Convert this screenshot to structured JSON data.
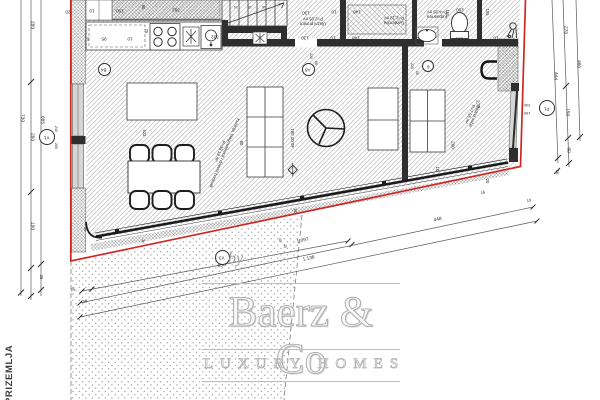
{
  "title": "PRIZEMLJA",
  "watermark": {
    "by": "by",
    "brand": "Baerz & Co",
    "tagline": "LUXURY HOMES"
  },
  "level_marker": "±0.00 381",
  "accent_red": "#cf2822",
  "rooms": [
    {
      "name": "Kuhinja, blagovaonica i dnevni boravak",
      "area": "P=38.19 m²",
      "x": 222,
      "y": 152,
      "r": 112,
      "s": 4.3,
      "w": 88
    },
    {
      "name": "Ulazni prostor",
      "area": "P=2.05 m²",
      "x": 313,
      "y": 21,
      "r": 180,
      "s": 4.3,
      "w": 0
    },
    {
      "name": "Garderoba",
      "area": "P=2.19 m²",
      "x": 394,
      "y": 20,
      "r": 180,
      "s": 4.3,
      "w": 0
    },
    {
      "name": "Kupaonica",
      "area": "P=4.05 m²",
      "x": 437,
      "y": 14,
      "r": 180,
      "s": 4.3,
      "w": 0
    },
    {
      "name": "Radna soba",
      "area": "P=7.55 m²",
      "x": 472,
      "y": 115,
      "r": 112,
      "s": 4.3,
      "w": 0
    }
  ],
  "circles": [
    {
      "t": "V1",
      "x": 47,
      "y": 137,
      "d": 16
    },
    {
      "t": "B4",
      "x": 104,
      "y": 69,
      "d": 13
    },
    {
      "t": "A8",
      "x": 308,
      "y": 69,
      "d": 13
    },
    {
      "t": "6",
      "x": 428,
      "y": 66,
      "d": 12
    },
    {
      "t": "V3",
      "x": 222,
      "y": 257,
      "d": 15
    },
    {
      "t": "P1",
      "x": 547,
      "y": 108,
      "d": 16
    }
  ],
  "dims": [
    {
      "t": "20",
      "x": 68,
      "y": 11,
      "r": 180,
      "s": 4.6
    },
    {
      "t": "10",
      "x": 92,
      "y": 10,
      "r": 180,
      "s": 4.6
    },
    {
      "t": "100",
      "x": 120,
      "y": 10,
      "r": 180,
      "s": 4.6
    },
    {
      "t": "392",
      "x": 176,
      "y": 9,
      "r": 180,
      "s": 4.6
    },
    {
      "t": "90",
      "x": 143,
      "y": 7,
      "r": 90,
      "s": 4.2
    },
    {
      "t": "75",
      "x": 146,
      "y": 31,
      "r": 90,
      "s": 4.2
    },
    {
      "t": "5",
      "x": 88,
      "y": 38,
      "r": 180,
      "s": 4.6
    },
    {
      "t": "95",
      "x": 104,
      "y": 38,
      "r": 180,
      "s": 4.6
    },
    {
      "t": "10",
      "x": 130,
      "y": 38,
      "r": 180,
      "s": 4.6
    },
    {
      "t": "332",
      "x": 215,
      "y": 36,
      "r": 180,
      "s": 4.6
    },
    {
      "t": "14",
      "x": 236,
      "y": 6,
      "r": 180,
      "s": 3.6
    },
    {
      "t": "15",
      "x": 250,
      "y": 6,
      "r": 180,
      "s": 3.6
    },
    {
      "t": "16",
      "x": 264,
      "y": 6,
      "r": 180,
      "s": 3.6
    },
    {
      "t": "130",
      "x": 306,
      "y": 12,
      "r": 180,
      "s": 4.6
    },
    {
      "t": "10",
      "x": 334,
      "y": 11,
      "r": 180,
      "s": 4.6
    },
    {
      "t": "148",
      "x": 357,
      "y": 11,
      "r": 180,
      "s": 4.6
    },
    {
      "t": "130",
      "x": 305,
      "y": 37,
      "r": 180,
      "s": 4.6
    },
    {
      "t": "10",
      "x": 333,
      "y": 37,
      "r": 180,
      "s": 4.6
    },
    {
      "t": "148",
      "x": 356,
      "y": 37,
      "r": 180,
      "s": 4.6
    },
    {
      "t": "220",
      "x": 310,
      "y": 56,
      "r": 90,
      "s": 3.5
    },
    {
      "t": "06",
      "x": 315,
      "y": 63,
      "r": 90,
      "s": 3.5
    },
    {
      "t": "155",
      "x": 447,
      "y": 13,
      "r": 90,
      "s": 4.2
    },
    {
      "t": "260",
      "x": 460,
      "y": 9,
      "r": 180,
      "s": 4.6
    },
    {
      "t": "260",
      "x": 459,
      "y": 38,
      "r": 180,
      "s": 4.6
    },
    {
      "t": "10",
      "x": 417,
      "y": 38,
      "r": 180,
      "s": 4.6
    },
    {
      "t": "10",
      "x": 496,
      "y": 37,
      "r": 180,
      "s": 4.6
    },
    {
      "t": "155",
      "x": 487,
      "y": 12,
      "r": 90,
      "s": 4.2
    },
    {
      "t": "220",
      "x": 411,
      "y": 66,
      "r": 90,
      "s": 3.5
    },
    {
      "t": "06",
      "x": 416,
      "y": 73,
      "r": 90,
      "s": 3.5
    },
    {
      "t": "273",
      "x": 477,
      "y": 104,
      "r": 90,
      "s": 4.6
    },
    {
      "t": "260",
      "x": 452,
      "y": 145,
      "r": 90,
      "s": 4.6
    },
    {
      "t": "10",
      "x": 437,
      "y": 169,
      "r": 90,
      "s": 4.2
    },
    {
      "t": "20",
      "x": 487,
      "y": 181,
      "r": 90,
      "s": 4.2
    },
    {
      "t": "240",
      "x": 527,
      "y": 105,
      "r": 180,
      "s": 4
    },
    {
      "t": "150",
      "x": 527,
      "y": 113,
      "r": 180,
      "s": 4
    },
    {
      "t": "522",
      "x": 144,
      "y": 133,
      "r": 90,
      "s": 4.2
    },
    {
      "t": "80",
      "x": 241,
      "y": 143,
      "r": 90,
      "s": 4.2
    },
    {
      "t": "50",
      "x": 295,
      "y": 211,
      "r": 90,
      "s": 4.2
    },
    {
      "t": "30",
      "x": 142,
      "y": 241,
      "r": 102,
      "s": 3.8
    },
    {
      "t": "30",
      "x": 84,
      "y": 229,
      "r": 90,
      "s": 3.8
    },
    {
      "t": "40",
      "x": 279,
      "y": 240,
      "r": 90,
      "s": 3.5
    },
    {
      "t": "25",
      "x": 284,
      "y": 246,
      "r": 90,
      "s": 3.5
    },
    {
      "t": "240",
      "x": 55,
      "y": 129,
      "r": 90,
      "s": 3.8
    },
    {
      "t": "260",
      "x": 55,
      "y": 146,
      "r": 90,
      "s": 3.8
    },
    {
      "t": "280",
      "x": 31,
      "y": 25,
      "r": 90,
      "s": 4.8
    },
    {
      "t": "260",
      "x": 31,
      "y": 137,
      "r": 90,
      "s": 4.8
    },
    {
      "t": "190",
      "x": 31,
      "y": 226,
      "r": 90,
      "s": 4.8
    },
    {
      "t": "730",
      "x": 21,
      "y": 118,
      "r": 90,
      "s": 4.8
    },
    {
      "t": "685",
      "x": 41,
      "y": 120,
      "r": 90,
      "s": 4.8
    },
    {
      "t": "25",
      "x": 41,
      "y": 277,
      "r": 90,
      "s": 4.2
    },
    {
      "t": "270",
      "x": 564,
      "y": 30,
      "r": 93,
      "s": 4.8
    },
    {
      "t": "150",
      "x": 566,
      "y": 112,
      "r": 93,
      "s": 4.8
    },
    {
      "t": "60",
      "x": 567,
      "y": 150,
      "r": 93,
      "s": 4.8
    },
    {
      "t": "480",
      "x": 577,
      "y": 64,
      "r": 93,
      "s": 4.8
    },
    {
      "t": "444",
      "x": 554,
      "y": 76,
      "r": 93,
      "s": 4.8
    },
    {
      "t": "16",
      "x": 557,
      "y": 172,
      "r": 93,
      "s": 4.2
    },
    {
      "t": "650",
      "x": 222,
      "y": 267,
      "r": -12,
      "s": 4.8
    },
    {
      "t": "1.097",
      "x": 303,
      "y": 242,
      "r": -12,
      "s": 4.8
    },
    {
      "t": "448",
      "x": 438,
      "y": 221,
      "r": -12,
      "s": 4.8
    },
    {
      "t": "1.138",
      "x": 309,
      "y": 260,
      "r": -12,
      "s": 4.8
    },
    {
      "t": "10",
      "x": 529,
      "y": 201,
      "r": -12,
      "s": 4.2
    },
    {
      "t": "25",
      "x": 73,
      "y": 290,
      "r": -12,
      "s": 4.2
    },
    {
      "t": "40",
      "x": 85,
      "y": 302,
      "r": -12,
      "s": 4.2
    },
    {
      "t": "16",
      "x": 483,
      "y": 193,
      "r": -12,
      "s": 4.2
    },
    {
      "t": "±0.00 381",
      "x": 293,
      "y": 138,
      "r": -90,
      "s": 4.4
    }
  ]
}
